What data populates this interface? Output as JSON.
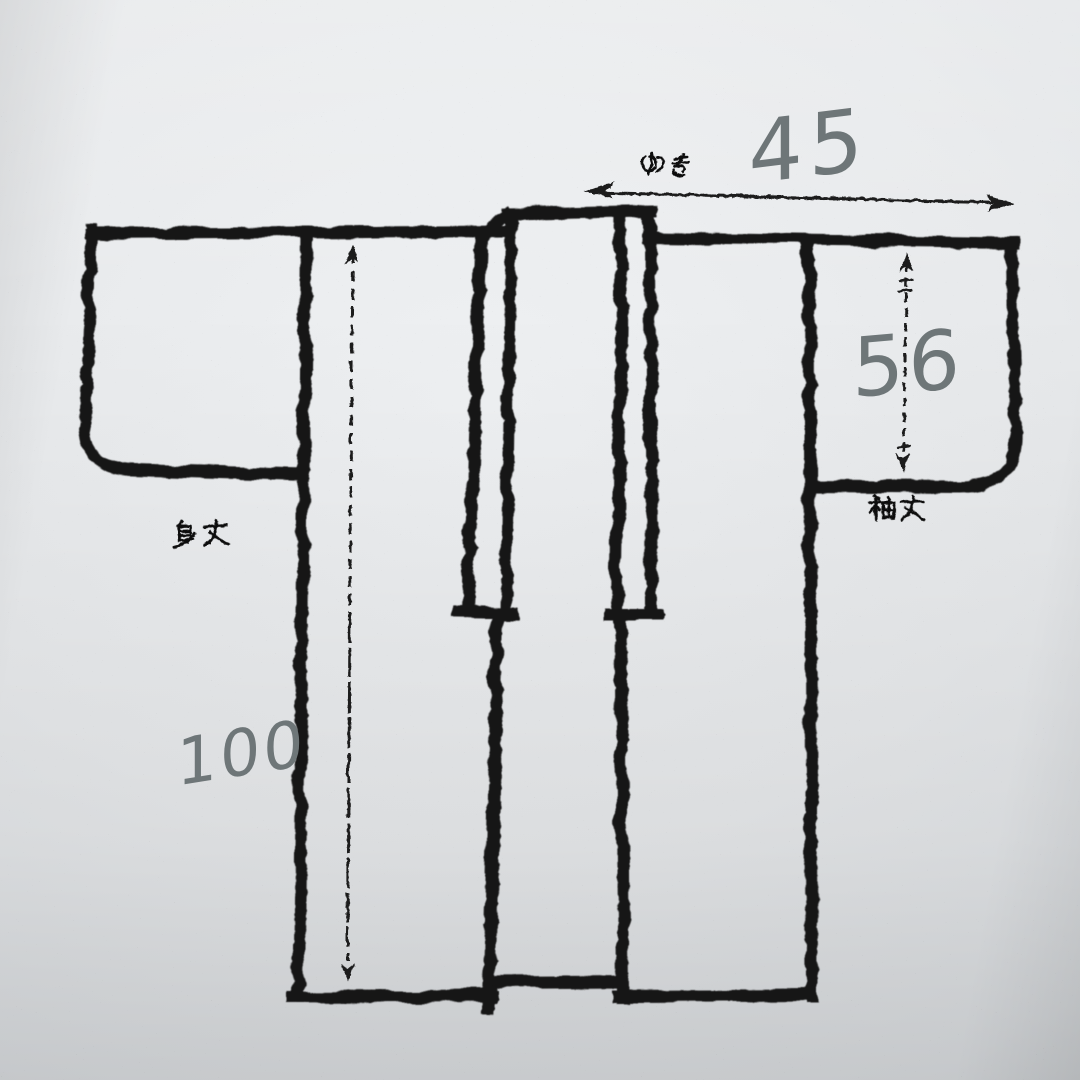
{
  "colors": {
    "paper": "#e7e9eb",
    "ink": "#171717",
    "handwriting_gray": "#6e7678"
  },
  "labels": {
    "yuki": "ゆき",
    "sode": "袖丈",
    "mitake": "身丈"
  },
  "values": {
    "yuki": "45",
    "sode": "56",
    "mitake": "100"
  }
}
